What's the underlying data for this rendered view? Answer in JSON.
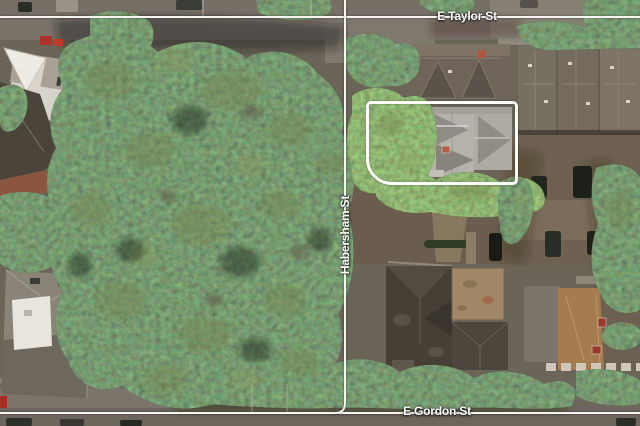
{
  "streets": {
    "taylor": {
      "label": "E Taylor St",
      "orientation": "horizontal"
    },
    "habersham": {
      "label": "Habersham St",
      "orientation": "vertical"
    },
    "gordon": {
      "label": "E Gordon St",
      "orientation": "horizontal"
    }
  },
  "overlay": {
    "line_color": "#f6f5f1",
    "label_color": "#ffffff",
    "outline_color": "#fdfdfa"
  },
  "scene_icons": {
    "property_outline": "highlight-box-icon",
    "street_line": "street-line-icon"
  }
}
